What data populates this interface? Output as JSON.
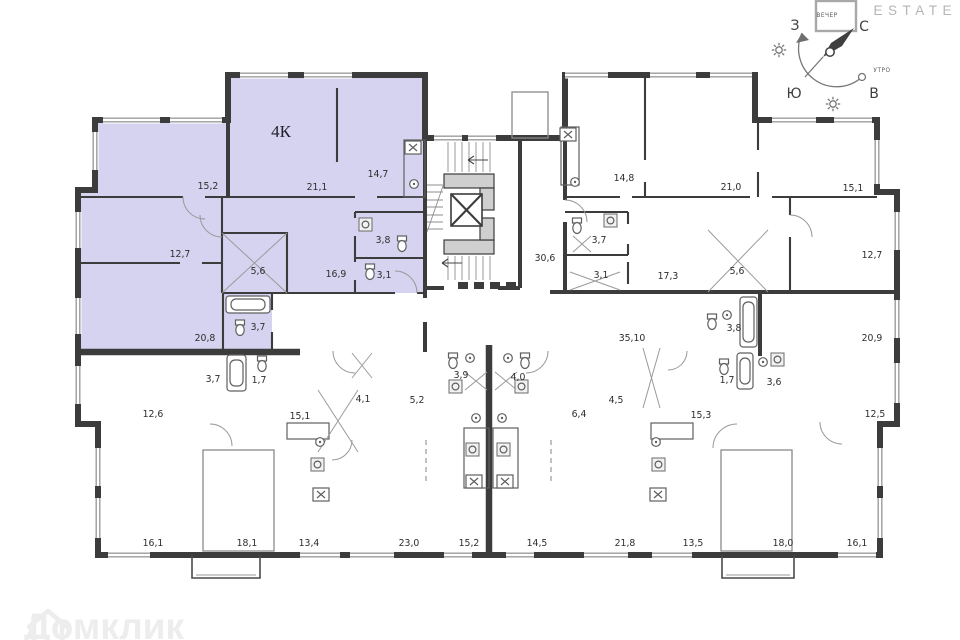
{
  "branding": {
    "logo_text": "ESTATE",
    "watermark": "Домклик"
  },
  "compass": {
    "north": "С",
    "south": "Ю",
    "west": "З",
    "east": "В",
    "evening_label": "ВЕЧЕР",
    "morning_label": "УТРО"
  },
  "plan": {
    "highlight_color": "#d5d3f0",
    "apartment_label": {
      "text": "4К",
      "x": 281,
      "y": 137
    },
    "rooms": [
      {
        "label": "15,2",
        "x": 208,
        "y": 189,
        "hl": true
      },
      {
        "label": "21,1",
        "x": 317,
        "y": 190,
        "hl": true
      },
      {
        "label": "14,7",
        "x": 378,
        "y": 177,
        "hl": true
      },
      {
        "label": "12,7",
        "x": 180,
        "y": 257,
        "hl": true
      },
      {
        "label": "5,6",
        "x": 258,
        "y": 274,
        "hl": true
      },
      {
        "label": "16,9",
        "x": 336,
        "y": 277,
        "hl": true
      },
      {
        "label": "3,8",
        "x": 383,
        "y": 243,
        "hl": true
      },
      {
        "label": "3,1",
        "x": 384,
        "y": 278,
        "hl": true
      },
      {
        "label": "20,8",
        "x": 205,
        "y": 341,
        "hl": true
      },
      {
        "label": "3,7",
        "x": 258,
        "y": 330,
        "hl": true
      },
      {
        "label": "30,6",
        "x": 545,
        "y": 261,
        "hl": false
      },
      {
        "label": "35,10",
        "x": 632,
        "y": 341,
        "hl": false
      },
      {
        "label": "14,8",
        "x": 624,
        "y": 181,
        "hl": false
      },
      {
        "label": "21,0",
        "x": 731,
        "y": 190,
        "hl": false
      },
      {
        "label": "15,1",
        "x": 853,
        "y": 191,
        "hl": false
      },
      {
        "label": "12,7",
        "x": 872,
        "y": 258,
        "hl": false
      },
      {
        "label": "3,7",
        "x": 599,
        "y": 243,
        "hl": false
      },
      {
        "label": "3,1",
        "x": 601,
        "y": 278,
        "hl": false
      },
      {
        "label": "17,3",
        "x": 668,
        "y": 279,
        "hl": false
      },
      {
        "label": "5,6",
        "x": 737,
        "y": 274,
        "hl": false
      },
      {
        "label": "3,7",
        "x": 213,
        "y": 382,
        "hl": false
      },
      {
        "label": "1,7",
        "x": 259,
        "y": 383,
        "hl": false
      },
      {
        "label": "12,6",
        "x": 153,
        "y": 417,
        "hl": false
      },
      {
        "label": "15,1",
        "x": 300,
        "y": 419,
        "hl": false
      },
      {
        "label": "16,1",
        "x": 153,
        "y": 546,
        "hl": false
      },
      {
        "label": "18,1",
        "x": 247,
        "y": 546,
        "hl": false
      },
      {
        "label": "4,1",
        "x": 363,
        "y": 402,
        "hl": false
      },
      {
        "label": "5,2",
        "x": 417,
        "y": 403,
        "hl": false
      },
      {
        "label": "3,9",
        "x": 461,
        "y": 378,
        "hl": false
      },
      {
        "label": "4,0",
        "x": 518,
        "y": 380,
        "hl": false
      },
      {
        "label": "13,4",
        "x": 309,
        "y": 546,
        "hl": false
      },
      {
        "label": "23,0",
        "x": 409,
        "y": 546,
        "hl": false
      },
      {
        "label": "15,2",
        "x": 469,
        "y": 546,
        "hl": false
      },
      {
        "label": "6,4",
        "x": 579,
        "y": 417,
        "hl": false
      },
      {
        "label": "4,5",
        "x": 616,
        "y": 403,
        "hl": false
      },
      {
        "label": "14,5",
        "x": 537,
        "y": 546,
        "hl": false
      },
      {
        "label": "21,8",
        "x": 625,
        "y": 546,
        "hl": false
      },
      {
        "label": "13,5",
        "x": 693,
        "y": 546,
        "hl": false
      },
      {
        "label": "3,8",
        "x": 734,
        "y": 331,
        "hl": false
      },
      {
        "label": "20,9",
        "x": 872,
        "y": 341,
        "hl": false
      },
      {
        "label": "1,7",
        "x": 727,
        "y": 383,
        "hl": false
      },
      {
        "label": "3,6",
        "x": 774,
        "y": 385,
        "hl": false
      },
      {
        "label": "15,3",
        "x": 701,
        "y": 418,
        "hl": false
      },
      {
        "label": "12,5",
        "x": 875,
        "y": 417,
        "hl": false
      },
      {
        "label": "18,0",
        "x": 783,
        "y": 546,
        "hl": false
      },
      {
        "label": "16,1",
        "x": 857,
        "y": 546,
        "hl": false
      }
    ]
  }
}
